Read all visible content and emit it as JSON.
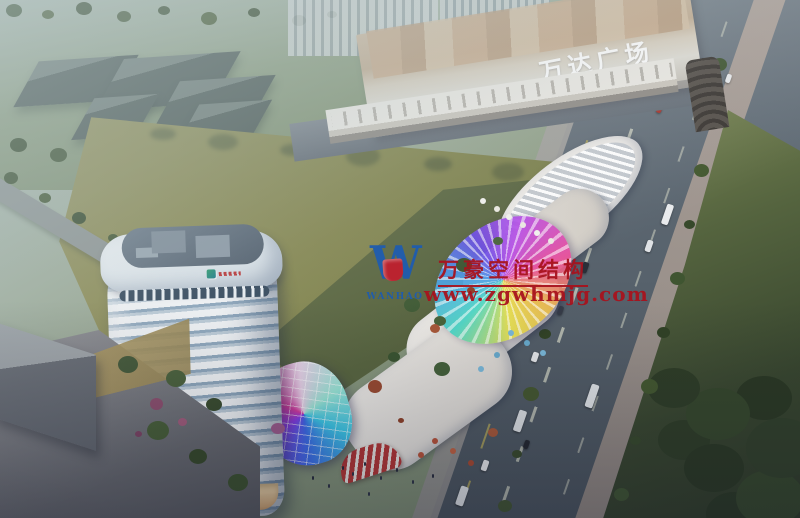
{
  "image": {
    "kind": "aerial architectural rendering at dusk",
    "description": "Bird's-eye render of a commercial plaza: white high-rise tower, curved retail podium with two rainbow membrane canopies, central lawn, Wanda Plaza building across the street, tree-lined arterial road with buses and cars on the right"
  },
  "signs": {
    "wanda_plaza": "万达广场"
  },
  "watermark": {
    "line1": "万豪空间结构",
    "line2": "www.zgwhmjg.com",
    "logo_letter": "W",
    "logo_name": "WANHAO",
    "text_color": "#a8121d",
    "logo_blue": "#1e5cb0",
    "shield_red": "#c01f2e"
  },
  "palette": {
    "haze": "#b7c6c4",
    "field_green": "#84854f",
    "field_shadow": "#4e5c3c",
    "road_grey": "#525f6b",
    "tower_white": "#eef2f5",
    "tower_glass": "#8ca6bc",
    "wanda_roof_tan": "#c9b49c",
    "lawn_dark": "#37452e",
    "canopy_rainbow": [
      "#3ac8e8",
      "#3a6ae8",
      "#8a3ae8",
      "#d83aa0",
      "#e8d84a",
      "#4ad8c6"
    ]
  }
}
